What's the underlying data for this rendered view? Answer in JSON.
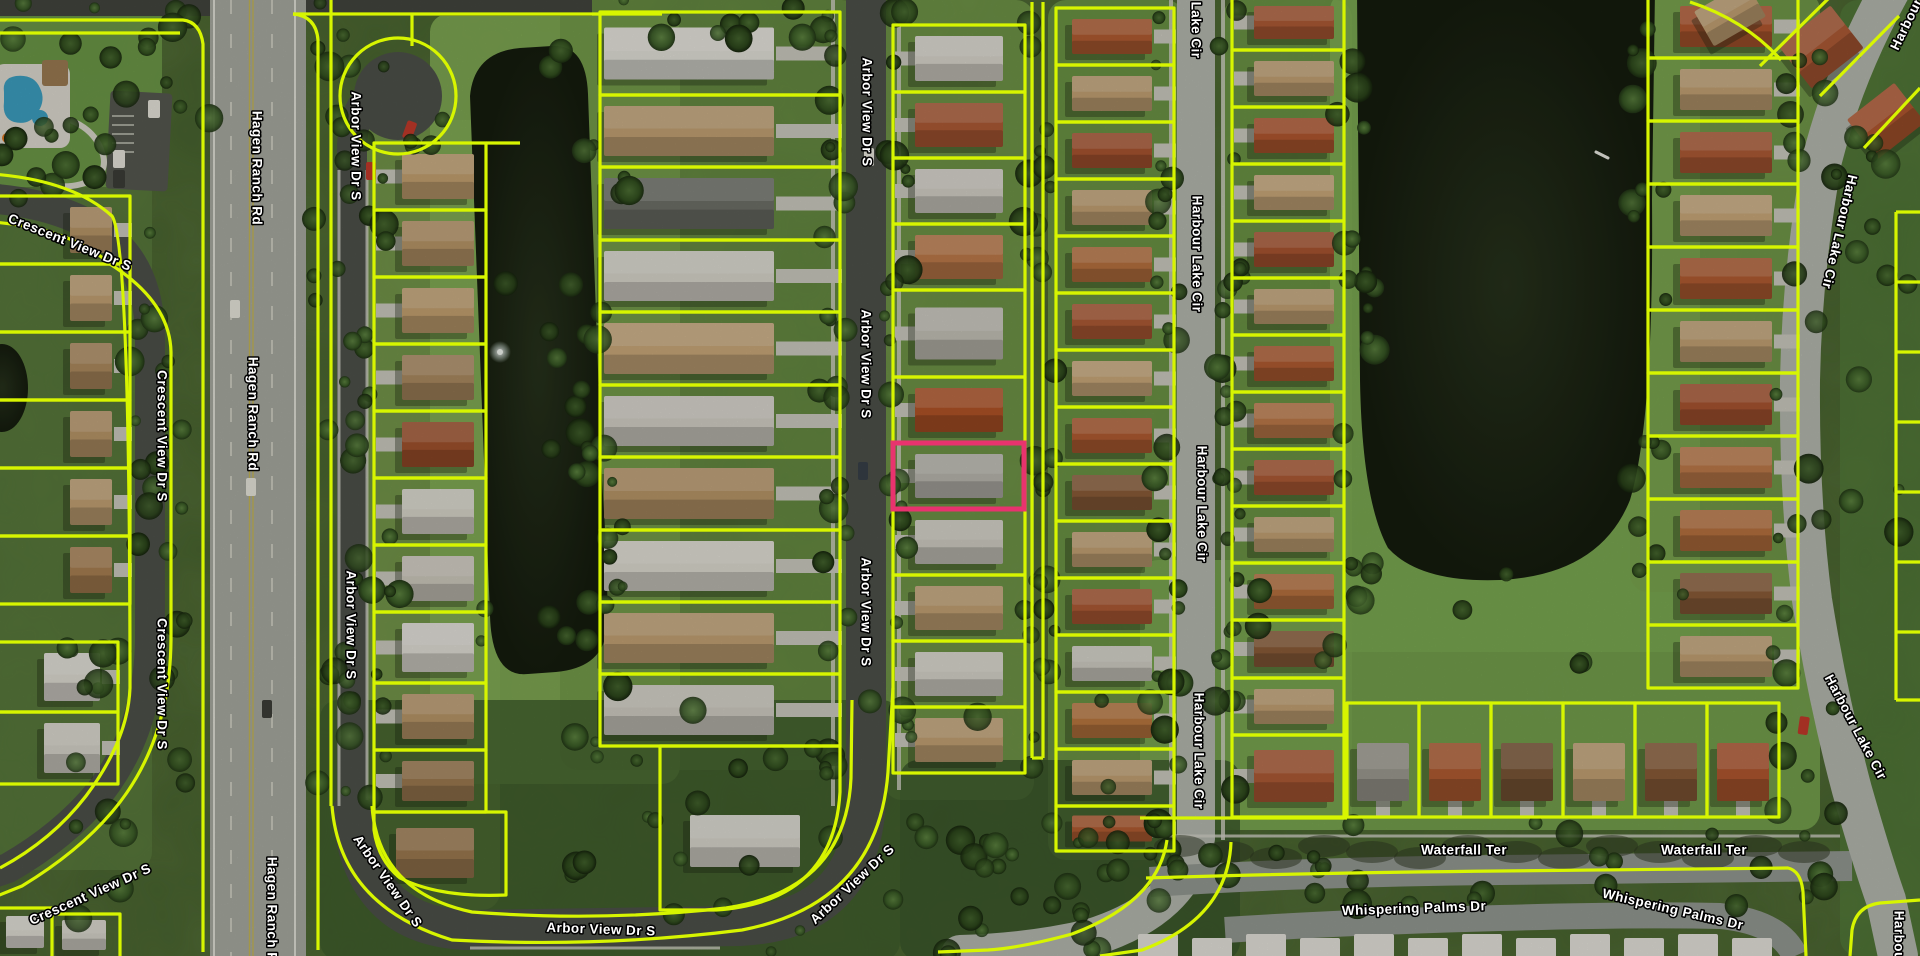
{
  "app": {
    "title": "Aerial Parcel Map"
  },
  "map": {
    "parcel_line_color": "#d7f500",
    "highlight_color": "#e8336e",
    "label_text_color": "#ffffff",
    "label_outline_color": "#000000",
    "selected_parcel": {
      "x": 893,
      "y": 443,
      "width": 131,
      "height": 66
    },
    "streets": {
      "crescent_view": "Crescent View Dr S",
      "hagen_ranch": "Hagen Ranch Rd",
      "arbor_view": "Arbor View Dr S",
      "harbour_lake": "Harbour Lake Cir",
      "harbour_lake_partial_top": "Lake Cir",
      "harbour_partial_corner": "Harbour",
      "harbour_partial_bottom": "Harbour L",
      "waterfall": "Waterfall Ter",
      "whispering": "Whispering Palms Dr"
    },
    "labels": [
      {
        "street": "crescent_view",
        "x": 70,
        "y": 242,
        "rot": 22
      },
      {
        "street": "crescent_view",
        "x": 162,
        "y": 436,
        "rot": 90
      },
      {
        "street": "crescent_view",
        "x": 162,
        "y": 684,
        "rot": 90
      },
      {
        "street": "crescent_view",
        "x": 90,
        "y": 894,
        "rot": -24
      },
      {
        "street": "hagen_ranch",
        "x": 257,
        "y": 168,
        "rot": 90
      },
      {
        "street": "hagen_ranch",
        "x": 253,
        "y": 414,
        "rot": 90
      },
      {
        "street": "hagen_ranch",
        "x": 272,
        "y": 914,
        "rot": 90
      },
      {
        "street": "arbor_view",
        "x": 356,
        "y": 146,
        "rot": 90
      },
      {
        "street": "arbor_view",
        "x": 351,
        "y": 625,
        "rot": 90
      },
      {
        "street": "arbor_view",
        "x": 388,
        "y": 881,
        "rot": 55
      },
      {
        "street": "arbor_view",
        "x": 601,
        "y": 929,
        "rot": 2
      },
      {
        "street": "arbor_view",
        "x": 852,
        "y": 884,
        "rot": -43
      },
      {
        "street": "arbor_view",
        "x": 867,
        "y": 112,
        "rot": 90
      },
      {
        "street": "arbor_view",
        "x": 866,
        "y": 364,
        "rot": 90
      },
      {
        "street": "arbor_view",
        "x": 866,
        "y": 612,
        "rot": 90
      },
      {
        "street": "harbour_lake_partial_top",
        "x": 1196,
        "y": 30,
        "rot": 90
      },
      {
        "street": "harbour_lake",
        "x": 1197,
        "y": 254,
        "rot": 90
      },
      {
        "street": "harbour_lake",
        "x": 1202,
        "y": 504,
        "rot": 90
      },
      {
        "street": "harbour_lake",
        "x": 1199,
        "y": 751,
        "rot": 90
      },
      {
        "street": "harbour_partial_corner",
        "x": 1906,
        "y": 24,
        "rot": -64
      },
      {
        "street": "harbour_lake",
        "x": 1840,
        "y": 232,
        "rot": 103
      },
      {
        "street": "harbour_lake",
        "x": 1856,
        "y": 727,
        "rot": 62
      },
      {
        "street": "harbour_partial_bottom",
        "x": 1899,
        "y": 945,
        "rot": 90
      },
      {
        "street": "waterfall",
        "x": 1464,
        "y": 850,
        "rot": 0
      },
      {
        "street": "waterfall",
        "x": 1704,
        "y": 850,
        "rot": 0
      },
      {
        "street": "whispering",
        "x": 1414,
        "y": 908,
        "rot": -2
      },
      {
        "street": "whispering",
        "x": 1673,
        "y": 909,
        "rot": 13
      }
    ],
    "parcels": {
      "columns": [
        {
          "id": "A",
          "x": [
            -8,
            130
          ],
          "front": "R",
          "gap": 10,
          "houseW": 42,
          "borders": [
            196,
            264,
            332,
            400,
            468,
            536,
            604
          ],
          "roofs": [
            "#b89668",
            "#c2a173",
            "#ad8a5e",
            "#b89668",
            "#c2a173",
            "#a87f52"
          ]
        },
        {
          "id": "A2",
          "x": [
            -8,
            118
          ],
          "front": "R",
          "gap": 10,
          "houseW": 56,
          "borders": [
            642,
            712,
            784
          ],
          "roofs": [
            "#dedbd2",
            "#d6d3c9"
          ]
        },
        {
          "id": "E",
          "x": [
            374,
            486
          ],
          "front": "L",
          "gap": 20,
          "houseW": 72,
          "borders": [
            143,
            210,
            277,
            344,
            411,
            478,
            545,
            612,
            683,
            750,
            812
          ],
          "roofs": [
            "#c3a170",
            "#b89668",
            "#c3a170",
            "#ab8a60",
            "#a0522d",
            "#d8d5ca",
            "#cdc9bd",
            "#e0ded5",
            "#b89668",
            "#9c7a50"
          ]
        },
        {
          "id": "F",
          "x": [
            600,
            840
          ],
          "front": "R",
          "gap": 58,
          "houseW": 170,
          "borders": [
            12,
            95,
            167,
            240,
            312,
            385,
            457,
            530,
            602,
            674,
            746
          ],
          "roofs": [
            "#e2e0d8",
            "#c2a173",
            "#6e7068",
            "#d8d5cb",
            "#c9a87a",
            "#d3d0c6",
            "#b89668",
            "#dddad0",
            "#c2a173",
            "#cfccc2"
          ]
        },
        {
          "id": "H",
          "x": [
            893,
            1025
          ],
          "front": "L",
          "gap": 14,
          "houseW": 88,
          "borders": [
            25,
            92,
            158,
            224,
            290,
            377,
            443,
            509,
            575,
            641,
            707,
            773
          ],
          "roofs": [
            "#d9d6cc",
            "#ad5a35",
            "#d3d0c6",
            "#bd7a4a",
            "#c4c1b7",
            "#b05327",
            "#b9b7ae",
            "#cfccc2",
            "#c2a173",
            "#d6d3c9",
            "#c2a173"
          ]
        },
        {
          "id": "I",
          "x": [
            1056,
            1174
          ],
          "front": "R",
          "gap": 14,
          "houseW": 80,
          "borders": [
            8,
            65,
            122,
            179,
            236,
            293,
            350,
            407,
            464,
            521,
            578,
            635,
            692,
            749,
            806,
            851
          ],
          "roofs": [
            "#b05c32",
            "#c2a173",
            "#a85430",
            "#c2a173",
            "#b7713f",
            "#ad5a35",
            "#c9a87a",
            "#b05c32",
            "#8a5c38",
            "#c2a173",
            "#ad5a35",
            "#d0cdc3",
            "#b9773f",
            "#c2a173",
            "#b05c32"
          ]
        },
        {
          "id": "J",
          "x": [
            1232,
            1344
          ],
          "front": "L",
          "gap": 14,
          "houseW": 80,
          "borders": [
            -5,
            50,
            107,
            164,
            221,
            278,
            335,
            392,
            449,
            506,
            563,
            620,
            678,
            735,
            817
          ],
          "roofs": [
            "#ad5a35",
            "#c2a173",
            "#b0572f",
            "#c9a87a",
            "#a85430",
            "#c2a173",
            "#b05c32",
            "#bd7a4a",
            "#ad5a35",
            "#c2a173",
            "#b7713f",
            "#8a5c38",
            "#c2a173",
            "#ad5a35"
          ]
        },
        {
          "id": "K",
          "x": [
            1648,
            1798
          ],
          "front": "R",
          "gap": 18,
          "houseW": 92,
          "borders": [
            -5,
            58,
            121,
            184,
            247,
            310,
            373,
            436,
            499,
            562,
            625,
            688
          ],
          "roofs": [
            "#b0572f",
            "#c2a173",
            "#ad5a35",
            "#c9a87a",
            "#b05c32",
            "#c2a173",
            "#a85430",
            "#bd7a4a",
            "#b7713f",
            "#8a5c38",
            "#c2a173"
          ]
        },
        {
          "id": "W",
          "orient": "h",
          "y": [
            703,
            817
          ],
          "front": "B",
          "x_borders": [
            1347,
            1419,
            1491,
            1563,
            1635,
            1707,
            1779
          ],
          "roofs": [
            "#9c9a90",
            "#b05c32",
            "#7a5636",
            "#c2a173",
            "#8a5c38",
            "#b0572f"
          ]
        }
      ],
      "culdesac": {
        "cx": 398,
        "cy": 96,
        "r": 58
      },
      "extra_lines": [
        "M -5 20 H 183 Q 200 22 203 44 L 203 952",
        "M -5 33 H 180",
        "M 293 14 Q 316 16 318 40 L 318 950",
        "M 293 14 H 662",
        "M 412 14 V 46",
        "M 331 0 V 806",
        "M -8 174 Q 72 180 112 216 Q 130 242 130 688",
        "M -8 222 Q 70 228 110 264 Q 170 302 171 352 L 171 640 Q 170 744 112 812 Q 78 852 22 886 L -8 898",
        "M 130 688 Q 128 740 86 796 Q 52 840 0 868",
        "M 332 806 Q 340 906 452 940 Q 600 948 742 930 Q 878 904 888 772 L 893 688",
        "M 372 806 Q 378 892 472 912 Q 600 922 726 908 Q 846 890 851 778 L 852 700",
        "M 486 143 H 520",
        "M 1032 2 V 758",
        "M 1043 2 V 758",
        "M 1032 758 H 1043",
        "M 1167 840 Q 1158 902 1072 934 Q 1020 948 988 950 L 938 952",
        "M 1231 842 Q 1228 918 1142 950 L 1100 956",
        "M 1146 878 Q 1300 873 1500 871 L 1788 868 Q 1801 871 1803 892 L 1806 956",
        "M 1140 818 H 1347",
        "M 1832 -5 L 1760 66",
        "M 1899 16 L 1820 96",
        "M 1920 88 L 1864 148",
        "M 1896 212 V 700",
        "M 1896 212 H 1920",
        "M 1896 282 H 1920",
        "M 1896 352 H 1920",
        "M 1896 422 H 1920",
        "M 1896 492 H 1920",
        "M 1896 562 H 1920",
        "M 1896 632 H 1920",
        "M 1896 700 H 1920",
        "M -5 908 H 52 V 956",
        "M 52 914 H 120 V 956",
        "M 660 746 L 840 746 L 840 792 Q 834 902 716 910 L 660 910 Z",
        "M 374 812 H 506 V 895 Q 440 898 400 878 Q 378 860 374 830 Z",
        "M 1690 2 Q 1745 20 1781 60",
        "M 1850 956 L 1852 930 Q 1856 906 1880 903 L 1920 900"
      ],
      "extra_houses": [
        {
          "x": 690,
          "y": 815,
          "w": 110,
          "h": 52,
          "c": "#d8d6cc"
        },
        {
          "x": 396,
          "y": 828,
          "w": 78,
          "h": 50,
          "c": "#9c7a50"
        },
        {
          "x": 6,
          "y": 916,
          "w": 38,
          "h": 32,
          "c": "#dedbd2"
        },
        {
          "x": 62,
          "y": 920,
          "w": 44,
          "h": 30,
          "c": "#d6d3c9"
        },
        {
          "x": 1788,
          "y": 20,
          "w": 66,
          "h": 54,
          "c": "#ad5a35",
          "rot": -38
        },
        {
          "x": 1856,
          "y": 96,
          "w": 60,
          "h": 50,
          "c": "#b0572f",
          "rot": -38
        },
        {
          "x": 1700,
          "y": -6,
          "w": 60,
          "h": 40,
          "c": "#c2a173",
          "rot": -30
        }
      ]
    },
    "roads": {
      "asphalt_dark": "#4d514a",
      "highway": "#a7a9a0",
      "residential_light": "#b4b8ae",
      "shaded": "#939891",
      "top_road": "#42453e"
    },
    "trailers": {
      "y": 934,
      "x_start": 1138,
      "count": 12,
      "w": 40,
      "h": 24,
      "step": 54,
      "color": "#e4e2da"
    },
    "pool": {
      "water_color": "#3d9fc0",
      "deck_color": "#ddd9cf",
      "umbrella_color": "#e07820",
      "gazebo_color": "#9b7b52"
    }
  }
}
